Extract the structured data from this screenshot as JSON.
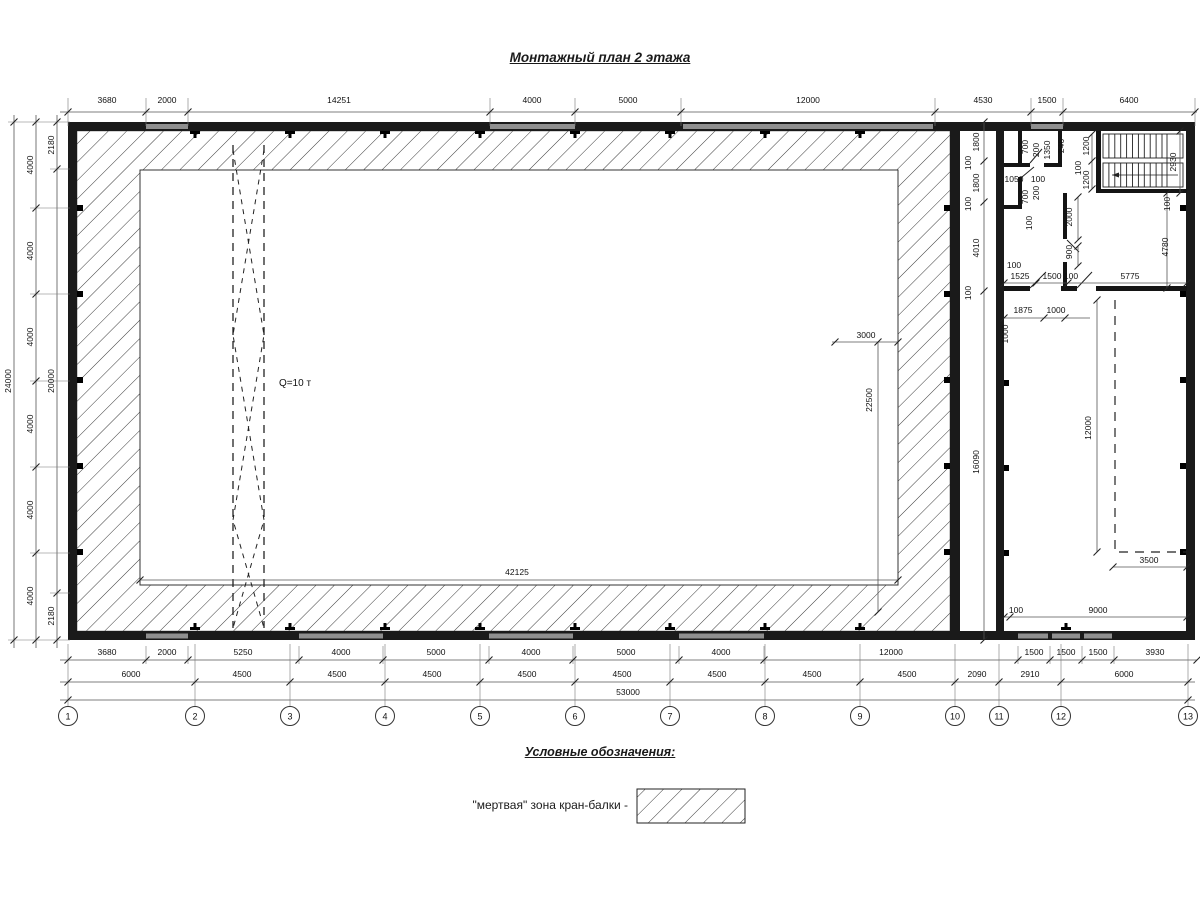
{
  "title": "Монтажный план 2 этажа",
  "legend": {
    "heading": "Условные обозначения:",
    "item": "\"мертвая\" зона кран-балки -"
  },
  "plan": {
    "crane_capacity_label": "Q=10 т",
    "axis_bubbles": [
      {
        "label": "1",
        "x": 68
      },
      {
        "label": "2",
        "x": 195
      },
      {
        "label": "3",
        "x": 290
      },
      {
        "label": "4",
        "x": 385
      },
      {
        "label": "5",
        "x": 480
      },
      {
        "label": "6",
        "x": 575
      },
      {
        "label": "7",
        "x": 670
      },
      {
        "label": "8",
        "x": 765
      },
      {
        "label": "9",
        "x": 860
      },
      {
        "label": "10",
        "x": 955
      },
      {
        "label": "11",
        "x": 999
      },
      {
        "label": "12",
        "x": 1061
      },
      {
        "label": "13",
        "x": 1188
      }
    ],
    "dimension_chains": {
      "top": [
        "3680",
        "2000",
        "14251",
        "4000",
        "5000",
        "12000",
        "4530",
        "1500",
        "6400"
      ],
      "left_outer_total": "24000",
      "left_grid": [
        "4000",
        "4000",
        "4000",
        "4000",
        "4000",
        "4000"
      ],
      "left_inner": [
        "2180",
        "20000",
        "2180"
      ],
      "bottom_wall": [
        "3680",
        "2000",
        "5250",
        "4000",
        "5000",
        "4000",
        "5000",
        "4000",
        "12000",
        "1500",
        "1500",
        "1500",
        "3930"
      ],
      "bottom_grid": [
        "6000",
        "4500",
        "4500",
        "4500",
        "4500",
        "4500",
        "4500",
        "4500",
        "4500",
        "2090",
        "2910",
        "6000"
      ],
      "bottom_total": "53000"
    },
    "dimension_labels": [
      {
        "g": "top",
        "t": "3680",
        "x": 107,
        "y": 103
      },
      {
        "g": "top",
        "t": "2000",
        "x": 167,
        "y": 103
      },
      {
        "g": "top",
        "t": "14251",
        "x": 339,
        "y": 103
      },
      {
        "g": "top",
        "t": "4000",
        "x": 532,
        "y": 103
      },
      {
        "g": "top",
        "t": "5000",
        "x": 628,
        "y": 103
      },
      {
        "g": "top",
        "t": "12000",
        "x": 808,
        "y": 103
      },
      {
        "g": "top",
        "t": "4530",
        "x": 983,
        "y": 103
      },
      {
        "g": "top",
        "t": "1500",
        "x": 1047,
        "y": 103
      },
      {
        "g": "top",
        "t": "6400",
        "x": 1129,
        "y": 103
      },
      {
        "g": "left",
        "t": "24000",
        "x": 11,
        "y": 381,
        "r": 1
      },
      {
        "g": "left",
        "t": "4000",
        "x": 33,
        "y": 165,
        "r": 1
      },
      {
        "g": "left",
        "t": "4000",
        "x": 33,
        "y": 251,
        "r": 1
      },
      {
        "g": "left",
        "t": "4000",
        "x": 33,
        "y": 337,
        "r": 1
      },
      {
        "g": "left",
        "t": "4000",
        "x": 33,
        "y": 424,
        "r": 1
      },
      {
        "g": "left",
        "t": "4000",
        "x": 33,
        "y": 510,
        "r": 1
      },
      {
        "g": "left",
        "t": "4000",
        "x": 33,
        "y": 596,
        "r": 1
      },
      {
        "g": "left",
        "t": "2180",
        "x": 54,
        "y": 145,
        "r": 1
      },
      {
        "g": "left",
        "t": "20000",
        "x": 54,
        "y": 381,
        "r": 1
      },
      {
        "g": "left",
        "t": "2180",
        "x": 54,
        "y": 616,
        "r": 1
      },
      {
        "g": "bottom1",
        "t": "3680",
        "x": 107,
        "y": 655
      },
      {
        "g": "bottom1",
        "t": "2000",
        "x": 167,
        "y": 655
      },
      {
        "g": "bottom1",
        "t": "5250",
        "x": 243,
        "y": 655
      },
      {
        "g": "bottom1",
        "t": "4000",
        "x": 341,
        "y": 655
      },
      {
        "g": "bottom1",
        "t": "5000",
        "x": 436,
        "y": 655
      },
      {
        "g": "bottom1",
        "t": "4000",
        "x": 531,
        "y": 655
      },
      {
        "g": "bottom1",
        "t": "5000",
        "x": 626,
        "y": 655
      },
      {
        "g": "bottom1",
        "t": "4000",
        "x": 721,
        "y": 655
      },
      {
        "g": "bottom1",
        "t": "12000",
        "x": 891,
        "y": 655
      },
      {
        "g": "bottom1",
        "t": "1500",
        "x": 1034,
        "y": 655
      },
      {
        "g": "bottom1",
        "t": "1500",
        "x": 1066,
        "y": 655
      },
      {
        "g": "bottom1",
        "t": "1500",
        "x": 1098,
        "y": 655
      },
      {
        "g": "bottom1",
        "t": "3930",
        "x": 1155,
        "y": 655
      },
      {
        "g": "bottom2",
        "t": "6000",
        "x": 131,
        "y": 677
      },
      {
        "g": "bottom2",
        "t": "4500",
        "x": 242,
        "y": 677
      },
      {
        "g": "bottom2",
        "t": "4500",
        "x": 337,
        "y": 677
      },
      {
        "g": "bottom2",
        "t": "4500",
        "x": 432,
        "y": 677
      },
      {
        "g": "bottom2",
        "t": "4500",
        "x": 527,
        "y": 677
      },
      {
        "g": "bottom2",
        "t": "4500",
        "x": 622,
        "y": 677
      },
      {
        "g": "bottom2",
        "t": "4500",
        "x": 717,
        "y": 677
      },
      {
        "g": "bottom2",
        "t": "4500",
        "x": 812,
        "y": 677
      },
      {
        "g": "bottom2",
        "t": "4500",
        "x": 907,
        "y": 677
      },
      {
        "g": "bottom2",
        "t": "2090",
        "x": 977,
        "y": 677
      },
      {
        "g": "bottom2",
        "t": "2910",
        "x": 1030,
        "y": 677
      },
      {
        "g": "bottom2",
        "t": "6000",
        "x": 1124,
        "y": 677
      },
      {
        "g": "bottom3",
        "t": "53000",
        "x": 628,
        "y": 695
      },
      {
        "g": "hall",
        "t": "Q=10 т",
        "x": 295,
        "y": 386,
        "s": 10
      },
      {
        "g": "hall",
        "t": "3000",
        "x": 866,
        "y": 338
      },
      {
        "g": "hall",
        "t": "22500",
        "x": 872,
        "y": 400,
        "r": 1
      },
      {
        "g": "hall",
        "t": "42125",
        "x": 517,
        "y": 575
      },
      {
        "g": "gap",
        "t": "1800",
        "x": 979,
        "y": 142,
        "r": 1
      },
      {
        "g": "gap",
        "t": "100",
        "x": 971,
        "y": 163,
        "r": 1
      },
      {
        "g": "gap",
        "t": "1800",
        "x": 979,
        "y": 183,
        "r": 1
      },
      {
        "g": "gap",
        "t": "100",
        "x": 971,
        "y": 204,
        "r": 1
      },
      {
        "g": "gap",
        "t": "4010",
        "x": 979,
        "y": 248,
        "r": 1
      },
      {
        "g": "gap",
        "t": "100",
        "x": 971,
        "y": 293,
        "r": 1
      },
      {
        "g": "gap",
        "t": "16090",
        "x": 979,
        "y": 462,
        "r": 1
      },
      {
        "g": "rooms",
        "t": "700",
        "x": 1028,
        "y": 147,
        "r": 1
      },
      {
        "g": "rooms",
        "t": "200",
        "x": 1039,
        "y": 150,
        "r": 1
      },
      {
        "g": "rooms",
        "t": "1350",
        "x": 1050,
        "y": 150,
        "r": 1
      },
      {
        "g": "rooms",
        "t": "246",
        "x": 1064,
        "y": 146,
        "r": 1
      },
      {
        "g": "rooms",
        "t": "1050",
        "x": 1014,
        "y": 182
      },
      {
        "g": "rooms",
        "t": "100",
        "x": 1038,
        "y": 182
      },
      {
        "g": "rooms",
        "t": "700",
        "x": 1028,
        "y": 197,
        "r": 1
      },
      {
        "g": "rooms",
        "t": "200",
        "x": 1039,
        "y": 193,
        "r": 1
      },
      {
        "g": "rooms",
        "t": "100",
        "x": 1032,
        "y": 223,
        "r": 1
      },
      {
        "g": "rooms",
        "t": "1000",
        "x": 1008,
        "y": 334,
        "r": 1
      },
      {
        "g": "rooms",
        "t": "2000",
        "x": 1072,
        "y": 217,
        "r": 1
      },
      {
        "g": "rooms",
        "t": "900",
        "x": 1072,
        "y": 252,
        "r": 1
      },
      {
        "g": "stairs",
        "t": "1200",
        "x": 1089,
        "y": 146,
        "r": 1
      },
      {
        "g": "stairs",
        "t": "100",
        "x": 1081,
        "y": 168,
        "r": 1
      },
      {
        "g": "stairs",
        "t": "1200",
        "x": 1089,
        "y": 180,
        "r": 1
      },
      {
        "g": "stairs",
        "t": "2930",
        "x": 1176,
        "y": 162,
        "r": 1
      },
      {
        "g": "stairs",
        "t": "100",
        "x": 1170,
        "y": 204,
        "r": 1
      },
      {
        "g": "stairs",
        "t": "4780",
        "x": 1168,
        "y": 247,
        "r": 1
      },
      {
        "g": "rooms",
        "t": "100",
        "x": 1014,
        "y": 268
      },
      {
        "g": "rooms",
        "t": "1525",
        "x": 1020,
        "y": 279
      },
      {
        "g": "rooms",
        "t": "1500",
        "x": 1052,
        "y": 279
      },
      {
        "g": "rooms",
        "t": "100",
        "x": 1071,
        "y": 279
      },
      {
        "g": "rooms",
        "t": "5775",
        "x": 1130,
        "y": 279
      },
      {
        "g": "rooms",
        "t": "1875",
        "x": 1023,
        "y": 313
      },
      {
        "g": "rooms",
        "t": "1000",
        "x": 1056,
        "y": 313
      },
      {
        "g": "bigroom",
        "t": "12000",
        "x": 1091,
        "y": 428,
        "r": 1
      },
      {
        "g": "bigroom",
        "t": "3500",
        "x": 1149,
        "y": 563
      },
      {
        "g": "bigroom",
        "t": "100",
        "x": 1016,
        "y": 613
      },
      {
        "g": "bigroom",
        "t": "9000",
        "x": 1098,
        "y": 613
      }
    ]
  }
}
